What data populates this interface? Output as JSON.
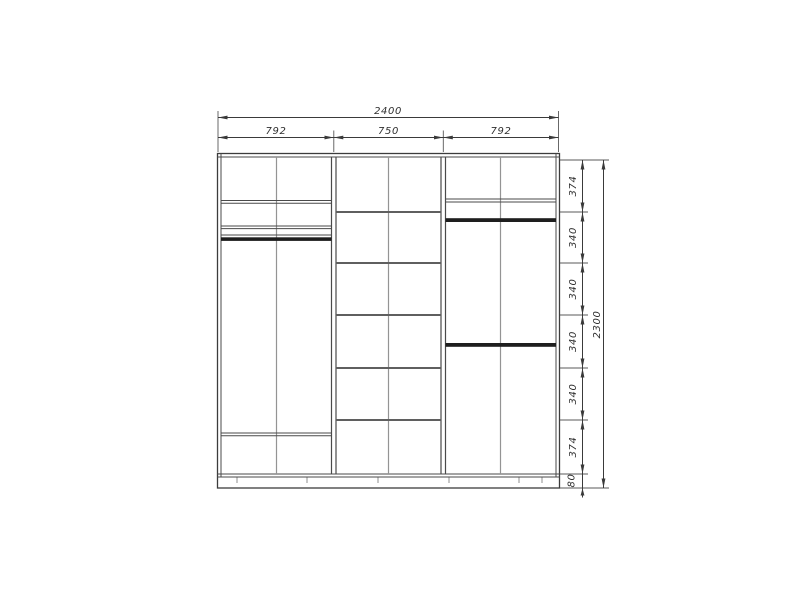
{
  "drawing": {
    "dims_top": {
      "overall": "2400",
      "sections": [
        "792",
        "750",
        "792"
      ]
    },
    "dims_right": {
      "segments": [
        "374",
        "340",
        "340",
        "340",
        "340",
        "374",
        "80"
      ],
      "overall": "2300"
    },
    "colors": {
      "background": "#ffffff",
      "outline": "#3c3c3c",
      "divider": "#949494",
      "dimension": "#3a3a3a",
      "rod": "#1e1e1e"
    }
  }
}
